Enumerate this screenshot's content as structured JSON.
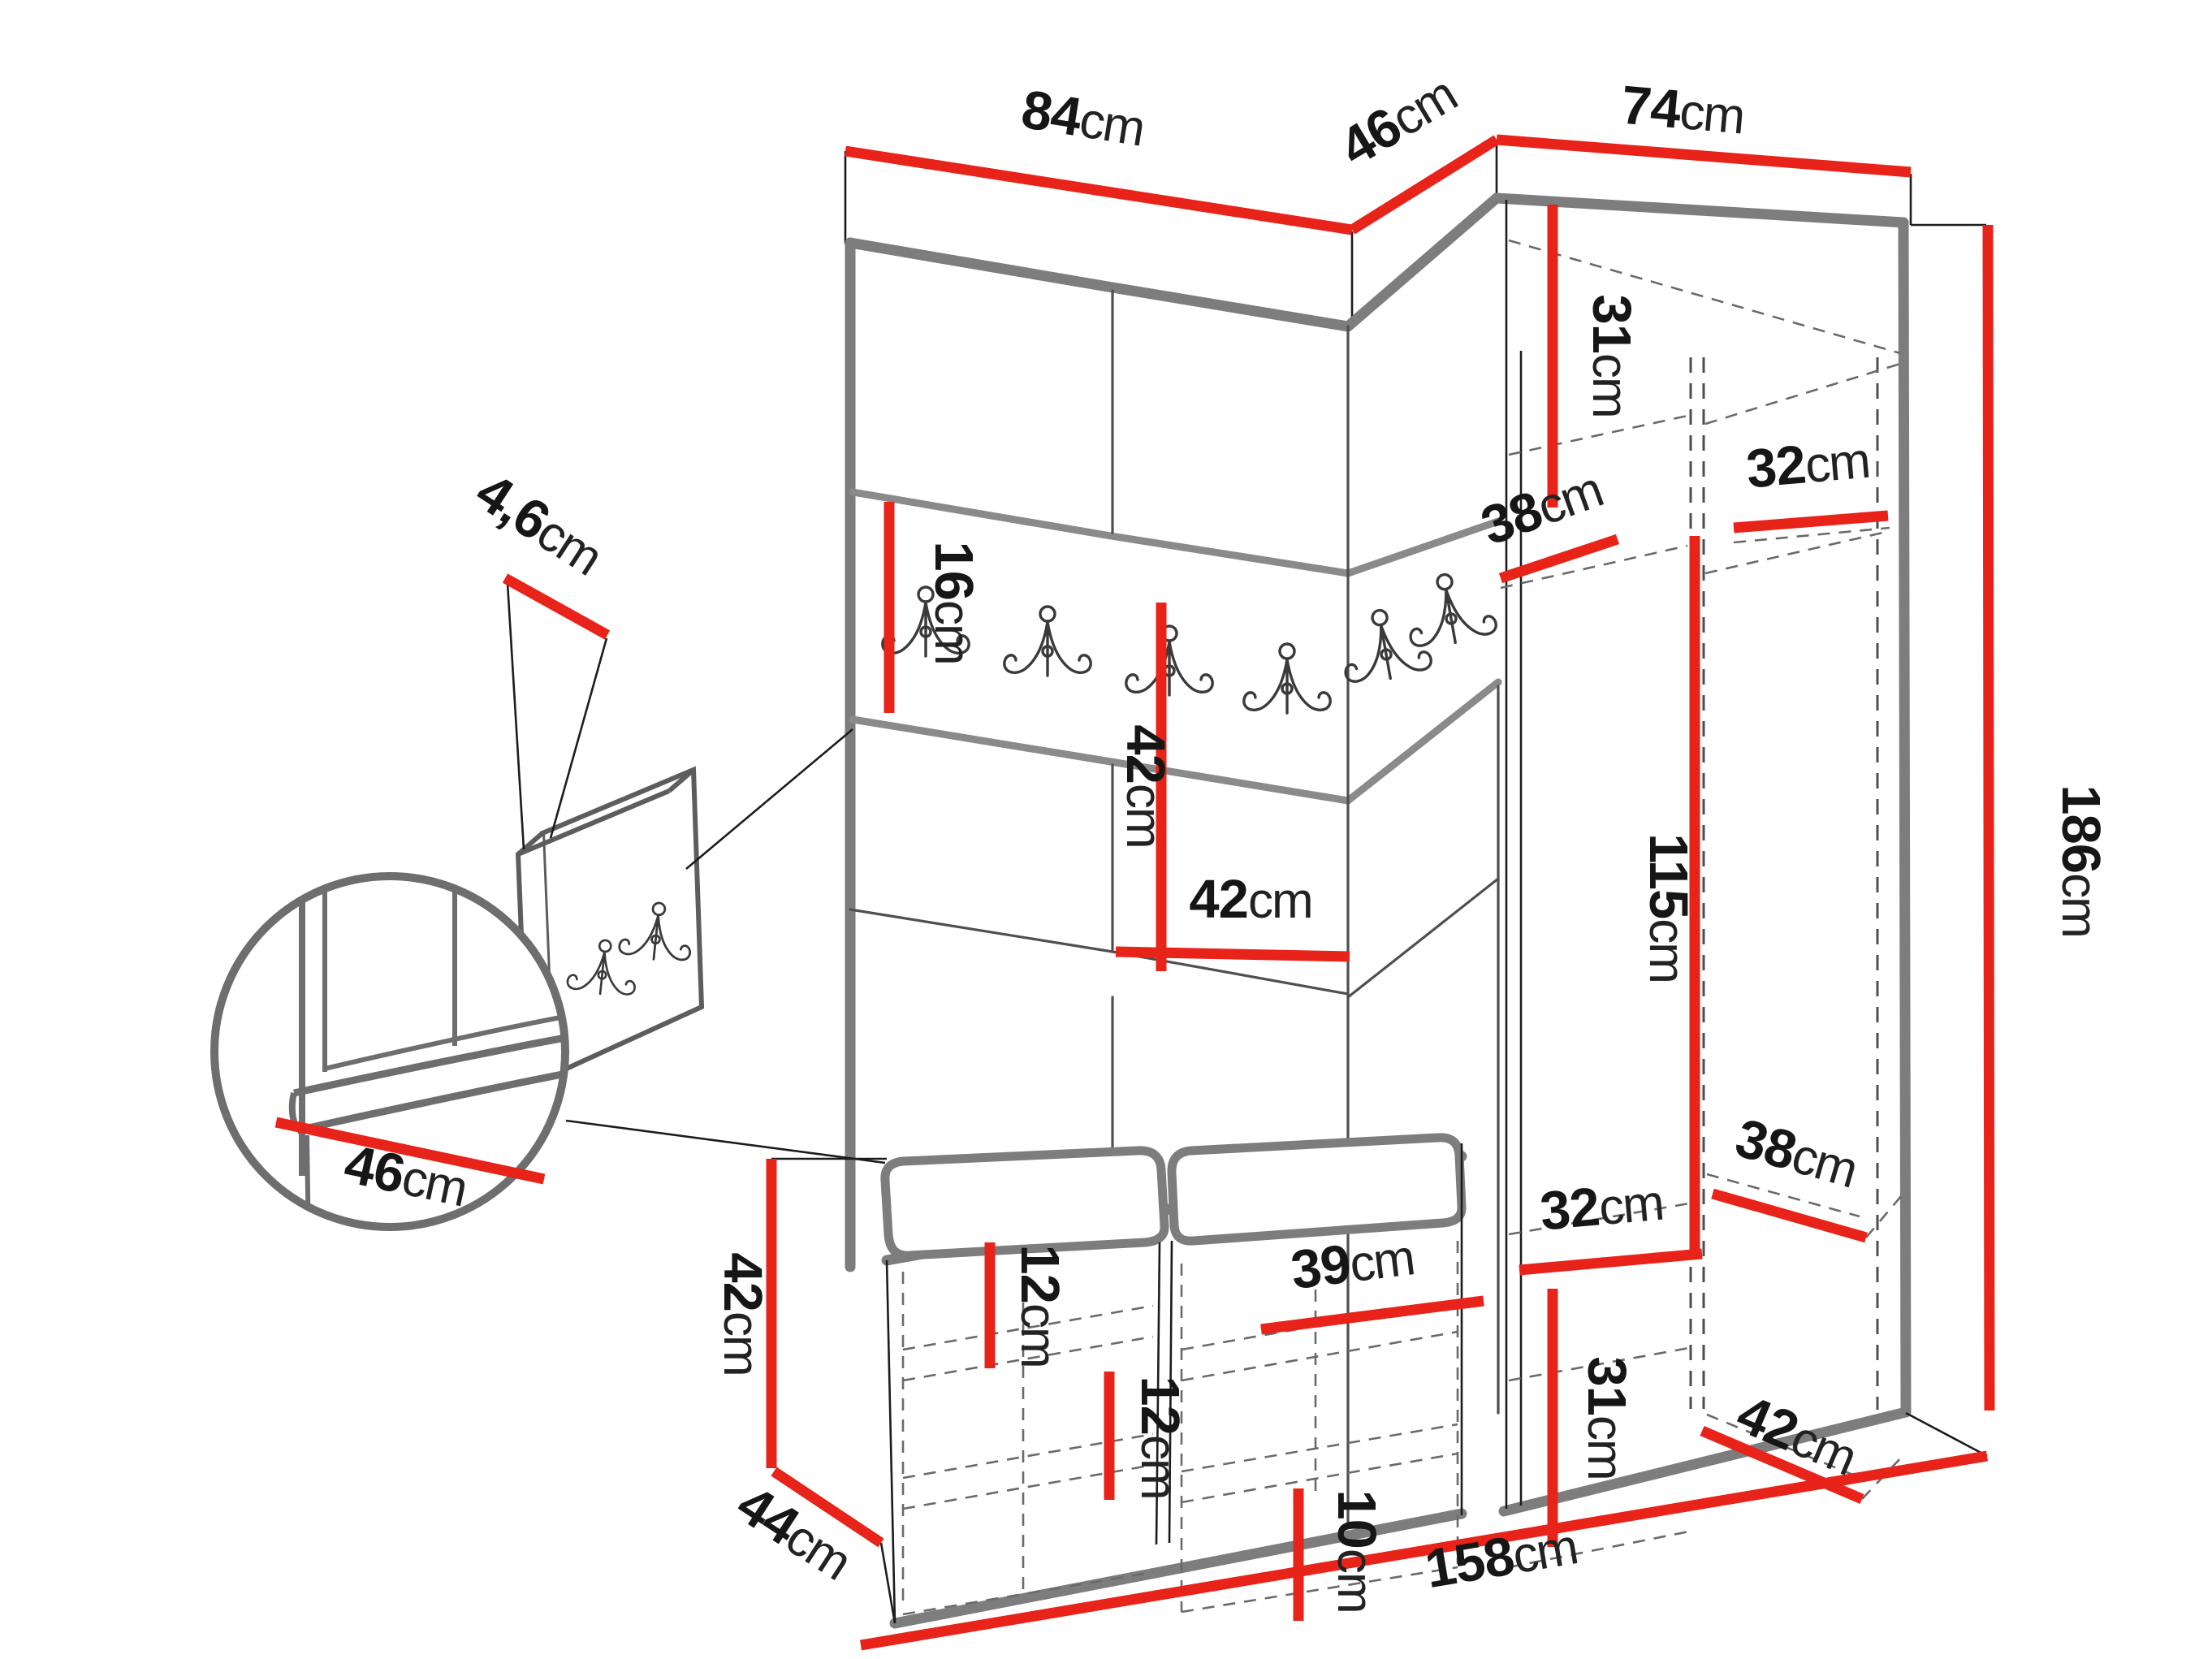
{
  "diagram": {
    "type": "furniture-dimension-diagram",
    "subject": "hallway set: panelled wall with coat hooks, corner wardrobe and shoe bench",
    "unit": "cm",
    "accent_color": "#e8231a",
    "edge_color": "#7d7d7d",
    "line_color": "#1c1c1c"
  },
  "labels": {
    "top_left_width": {
      "value": "84",
      "unit": "cm"
    },
    "corner_width": {
      "value": "46",
      "unit": "cm"
    },
    "wardrobe_width": {
      "value": "74",
      "unit": "cm"
    },
    "total_height": {
      "value": "186",
      "unit": "cm"
    },
    "rail_height": {
      "value": "16",
      "unit": "cm"
    },
    "panel_height": {
      "value": "42",
      "unit": "cm"
    },
    "panel_width": {
      "value": "42",
      "unit": "cm"
    },
    "panel_thickness": {
      "value": "4,6",
      "unit": "cm"
    },
    "seat_depth_detail": {
      "value": "46",
      "unit": "cm"
    },
    "bench_height": {
      "value": "42",
      "unit": "cm"
    },
    "bench_depth": {
      "value": "44",
      "unit": "cm"
    },
    "total_width": {
      "value": "158",
      "unit": "cm"
    },
    "shoe_gap_left": {
      "value": "12",
      "unit": "cm"
    },
    "shoe_gap_center": {
      "value": "12",
      "unit": "cm"
    },
    "shoe_shelf_width": {
      "value": "39",
      "unit": "cm"
    },
    "shoe_gap_bottom": {
      "value": "10",
      "unit": "cm"
    },
    "upper_section_height": {
      "value": "31",
      "unit": "cm"
    },
    "upper_shelf_depth": {
      "value": "38",
      "unit": "cm"
    },
    "upper_shelf_width": {
      "value": "32",
      "unit": "cm"
    },
    "hanging_height": {
      "value": "115",
      "unit": "cm"
    },
    "lower_shelf_width": {
      "value": "32",
      "unit": "cm"
    },
    "lower_section_height": {
      "value": "31",
      "unit": "cm"
    },
    "lower_shelf_depth": {
      "value": "38",
      "unit": "cm"
    },
    "bottom_shelf_depth": {
      "value": "42",
      "unit": "cm"
    }
  }
}
